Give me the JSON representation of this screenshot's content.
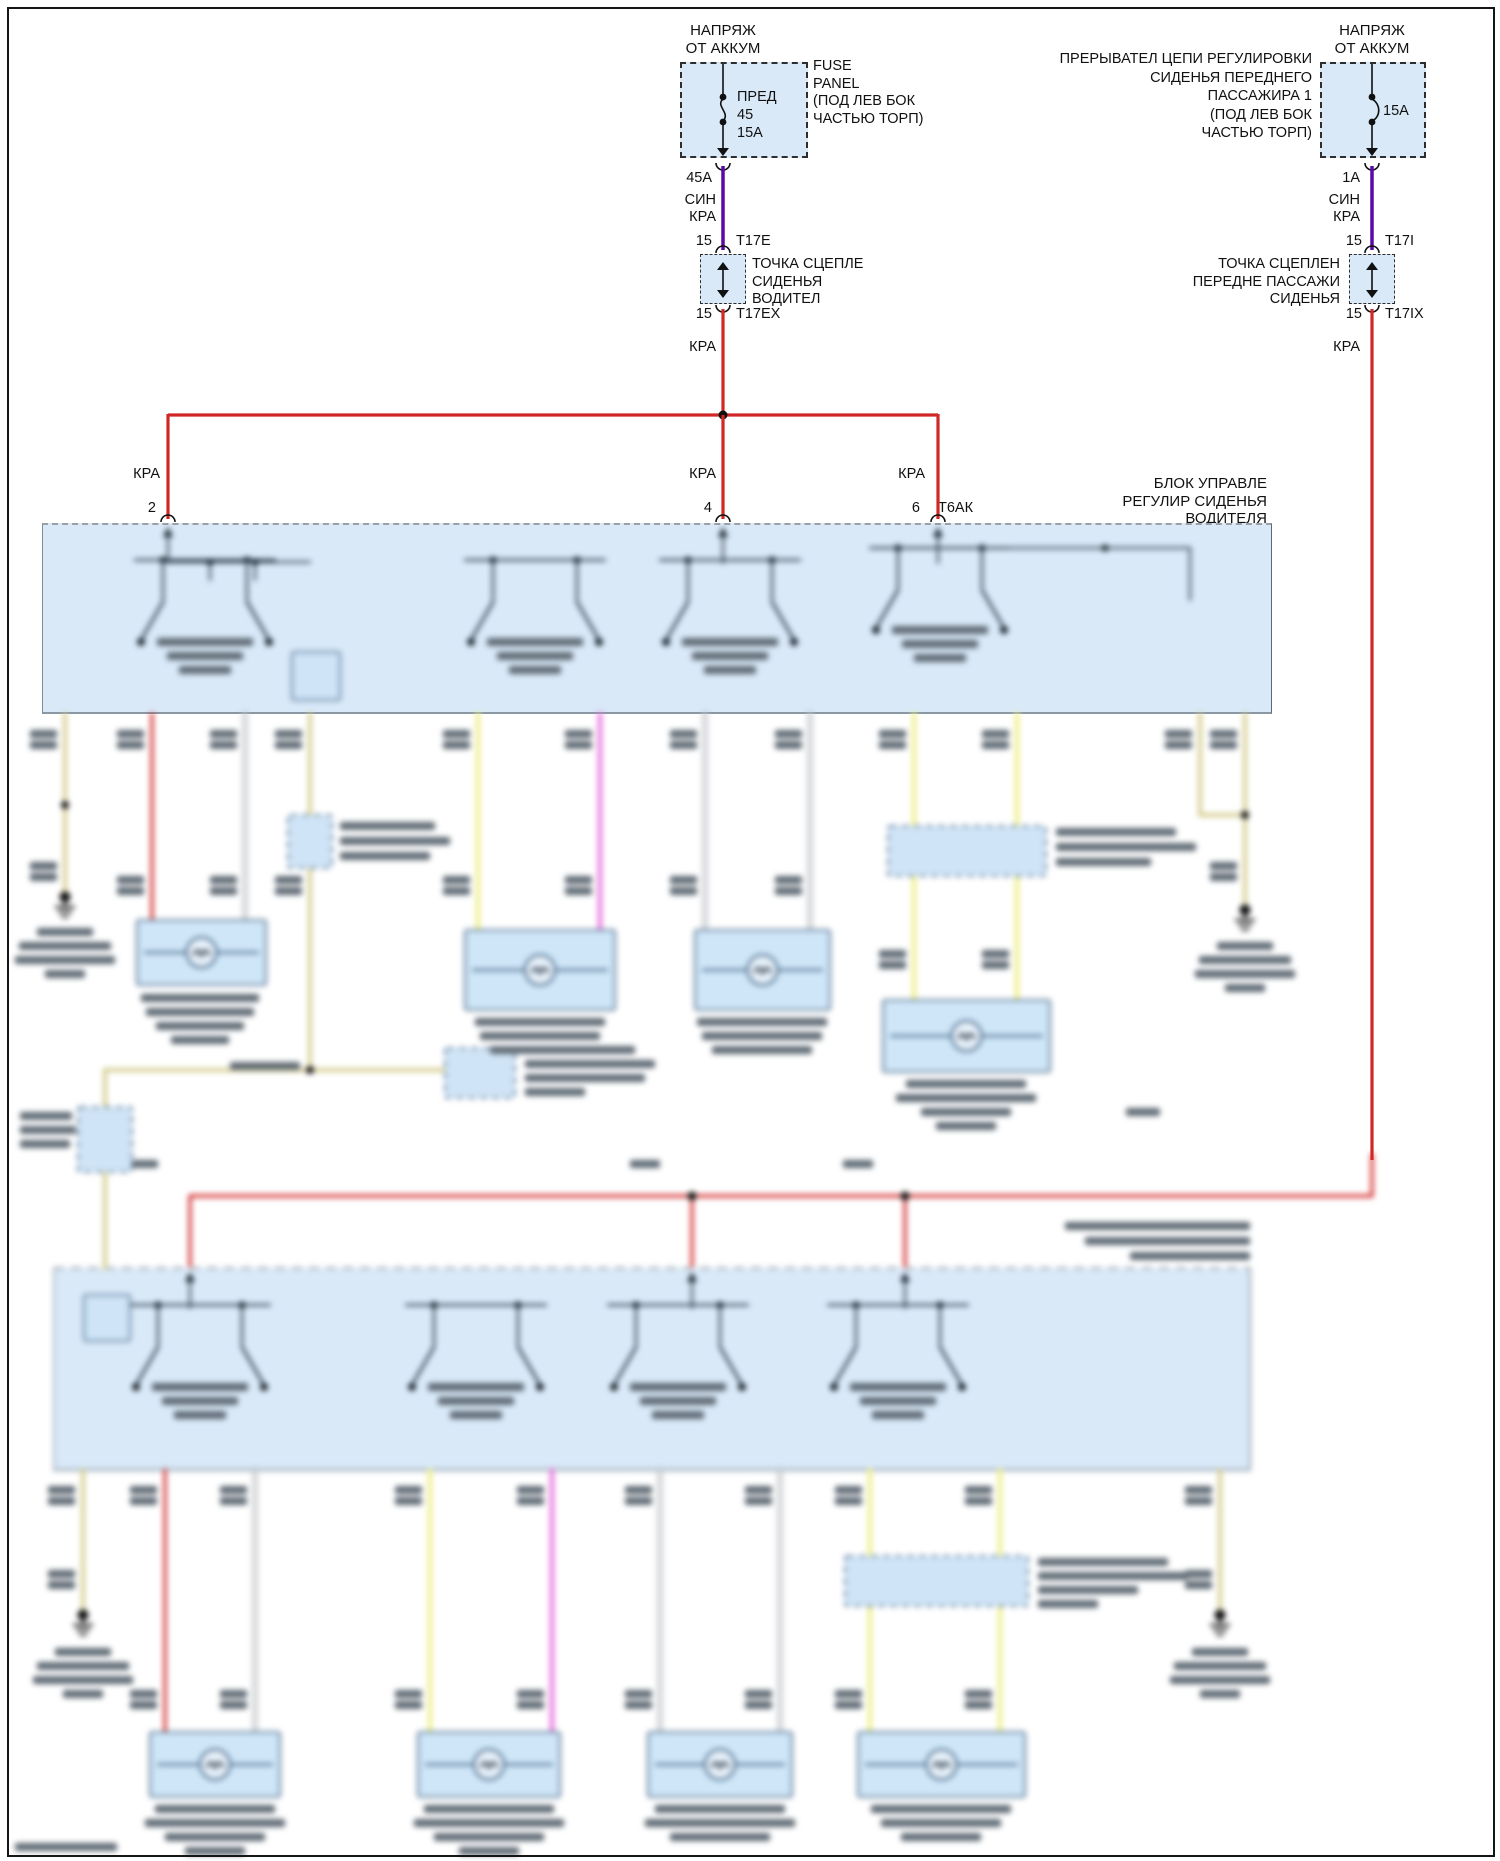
{
  "palette": {
    "page_bg": "#ffffff",
    "frame": "#151515",
    "box_fill": "#d9e9f8",
    "box_edge": "#6b7b8a",
    "dash_edge": "#9aa0a6",
    "wire_red": "#d22727",
    "wire_violet": "#5a0ba6",
    "wire_yellow": "#efef8e",
    "wire_magenta": "#e878e0",
    "wire_tan": "#d5cc90",
    "wire_white": "#f4f4f4",
    "wire_dark": "#32404d",
    "text": "#111111",
    "blur_text": "#5f6a74"
  },
  "battery_feed_left": {
    "header": [
      "НАПРЯЖ",
      "ОТ АККУМ"
    ],
    "fuse_name": "ПРЕД",
    "fuse_number": "45",
    "fuse_rating": "15А",
    "panel_label": [
      "FUSE",
      "PANEL",
      "(ПОД ЛЕВ БОК",
      "ЧАСТЬЮ ТОРП)"
    ],
    "wire_rating": "45А",
    "wire_colors": [
      "СИН",
      "КРА"
    ],
    "pin_top": "15",
    "connector_top": "T17E",
    "connector_label": [
      "ТОЧКА СЦЕПЛЕ",
      "СИДЕНЬЯ",
      "ВОДИТЕЛ"
    ],
    "pin_bottom": "15",
    "connector_bottom": "T17EX",
    "wire_color_out": "КРА"
  },
  "battery_feed_right": {
    "header": [
      "НАПРЯЖ",
      "ОТ АККУМ"
    ],
    "breaker_label": [
      "ПРЕРЫВАТЕЛ ЦЕПИ РЕГУЛИРОВКИ",
      "СИДЕНЬЯ ПЕРЕДНЕГО",
      "ПАССАЖИРА 1",
      "(ПОД ЛЕВ БОК",
      "ЧАСТЬЮ ТОРП)"
    ],
    "breaker_rating": "15А",
    "wire_rating": "1А",
    "wire_colors": [
      "СИН",
      "КРА"
    ],
    "pin_top": "15",
    "connector_top": "T17I",
    "connector_label": [
      "ТОЧКА СЦЕПЛЕН",
      "ПЕРЕДНЕ ПАССАЖИ",
      "СИДЕНЬЯ"
    ],
    "pin_bottom": "15",
    "connector_bottom": "T17IX",
    "wire_color_out": "КРА"
  },
  "driver_module": {
    "label": [
      "БЛОК УПРАВЛЕ",
      "РЕГУЛИР СИДЕНЬЯ",
      "ВОДИТЕЛЯ"
    ],
    "pins": [
      {
        "wire_color": "КРА",
        "pin": "2",
        "connector": ""
      },
      {
        "wire_color": "КРА",
        "pin": "4",
        "connector": ""
      },
      {
        "wire_color": "КРА",
        "pin": "6",
        "connector": "Т6АК"
      }
    ]
  }
}
